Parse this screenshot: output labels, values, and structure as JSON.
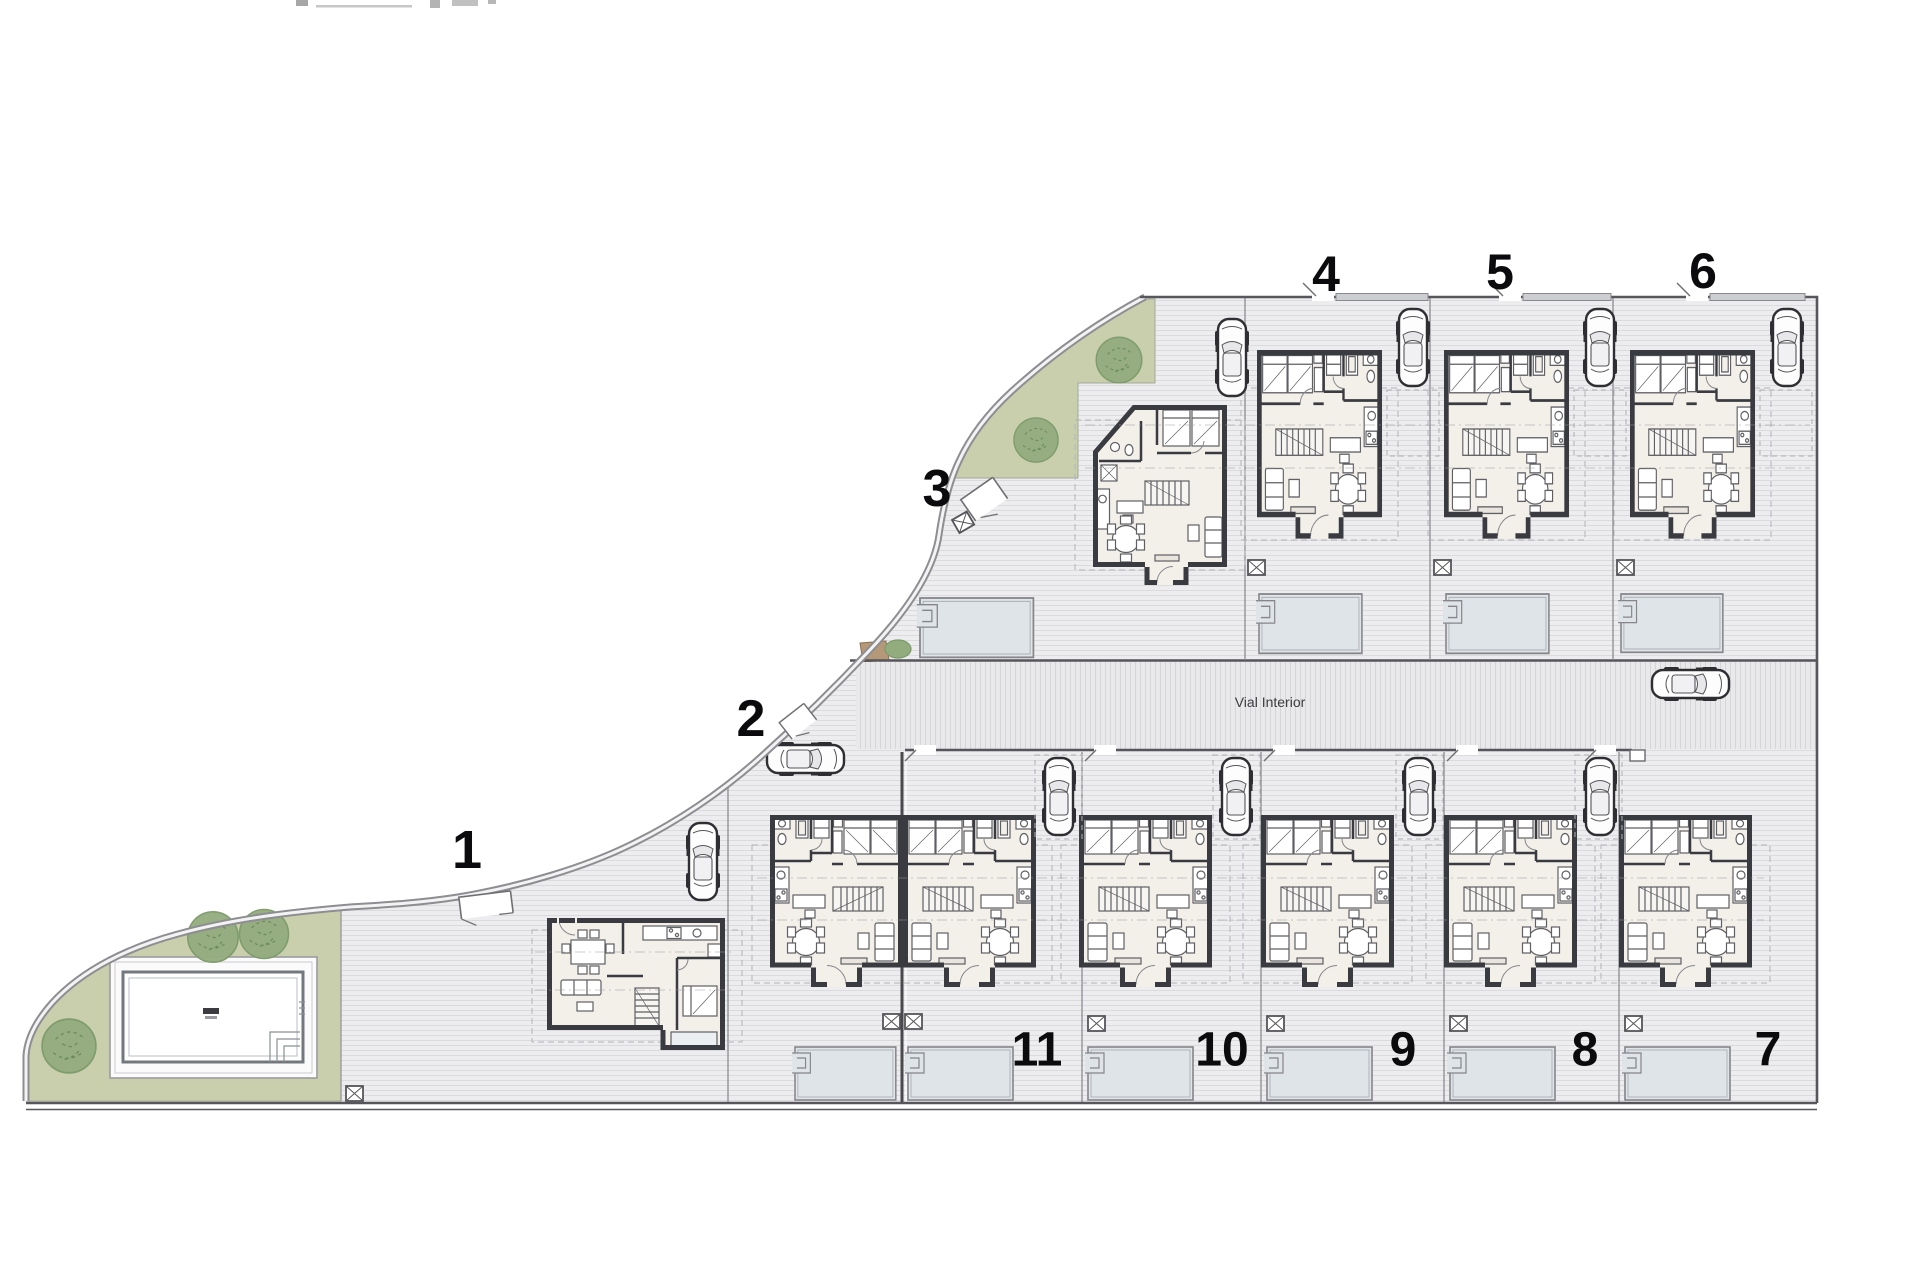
{
  "plan": {
    "kind": "residential site plan",
    "road": {
      "label": "Vial Interior"
    },
    "units": [
      {
        "label": "1"
      },
      {
        "label": "2"
      },
      {
        "label": "3"
      },
      {
        "label": "4"
      },
      {
        "label": "5"
      },
      {
        "label": "6"
      },
      {
        "label": "7"
      },
      {
        "label": "8"
      },
      {
        "label": "9"
      },
      {
        "label": "10"
      },
      {
        "label": "11"
      }
    ],
    "colors": {
      "paving": "#ededef",
      "paving_hatch": "#dbdbde",
      "road_hatch": "#d6d6d9",
      "green_area": "#c9cfad",
      "tree": "#93ac7e",
      "patio": "#dfe4e8",
      "house_wall": "#3a3b40",
      "house_floor": "#f3f0ea",
      "boundary": "#8e8e92",
      "label": "#0b0b0d",
      "soil": "#b59878"
    }
  }
}
